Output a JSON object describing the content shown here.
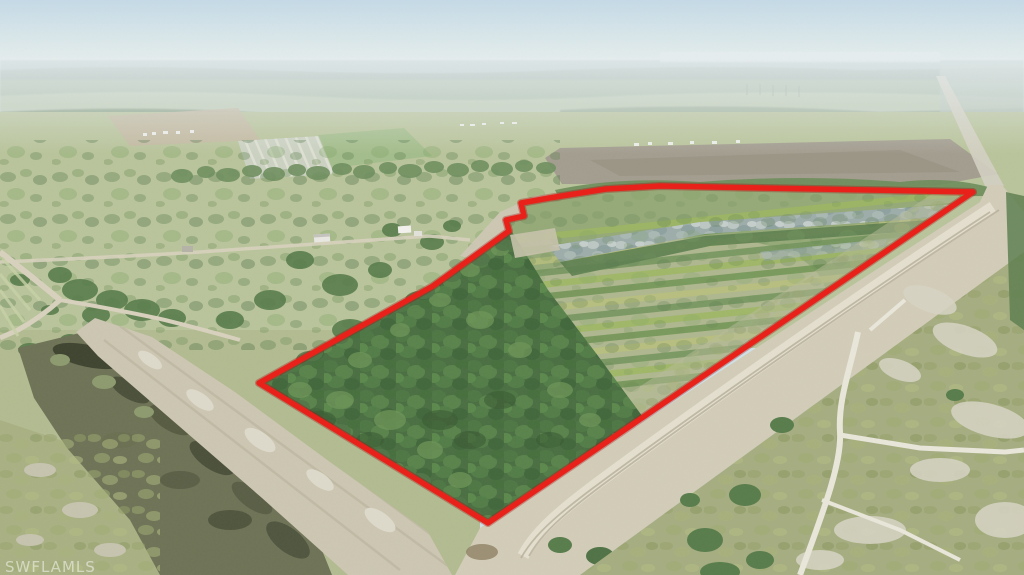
{
  "watermark": {
    "text": "SWFLAMLS",
    "color": "#ffffff"
  },
  "boundary": {
    "color": "#e8221b",
    "shadow_color": "#a31210"
  },
  "palette": {
    "sky_top": "#c5dae7",
    "sky_horizon": "#e9efee",
    "haze_band": "#afc2c2",
    "distant_trees": "#8fa690",
    "distant_fields": "#c3cdb4",
    "brown_field": "#a39d8f",
    "midground_pasture": "#b9c49b",
    "lower_pasture": "#b2bb90",
    "dirt_road": "#d2ccb8",
    "dirt_light": "#e5e1d2",
    "sand_strip": "#ccc6b2",
    "wetland": "#6e7356",
    "wetland_dark": "#3e442f",
    "parcel_base": "#95a977",
    "forest": "#4a6e42",
    "forest_light": "#6e9457",
    "rows_yellow": "#9db75f",
    "rows_green": "#6c9150",
    "rows_pale": "#b9c07c",
    "silver_trees": "#9dadaa",
    "scrub": "#a5ad80",
    "trail": "#e9e6da"
  }
}
